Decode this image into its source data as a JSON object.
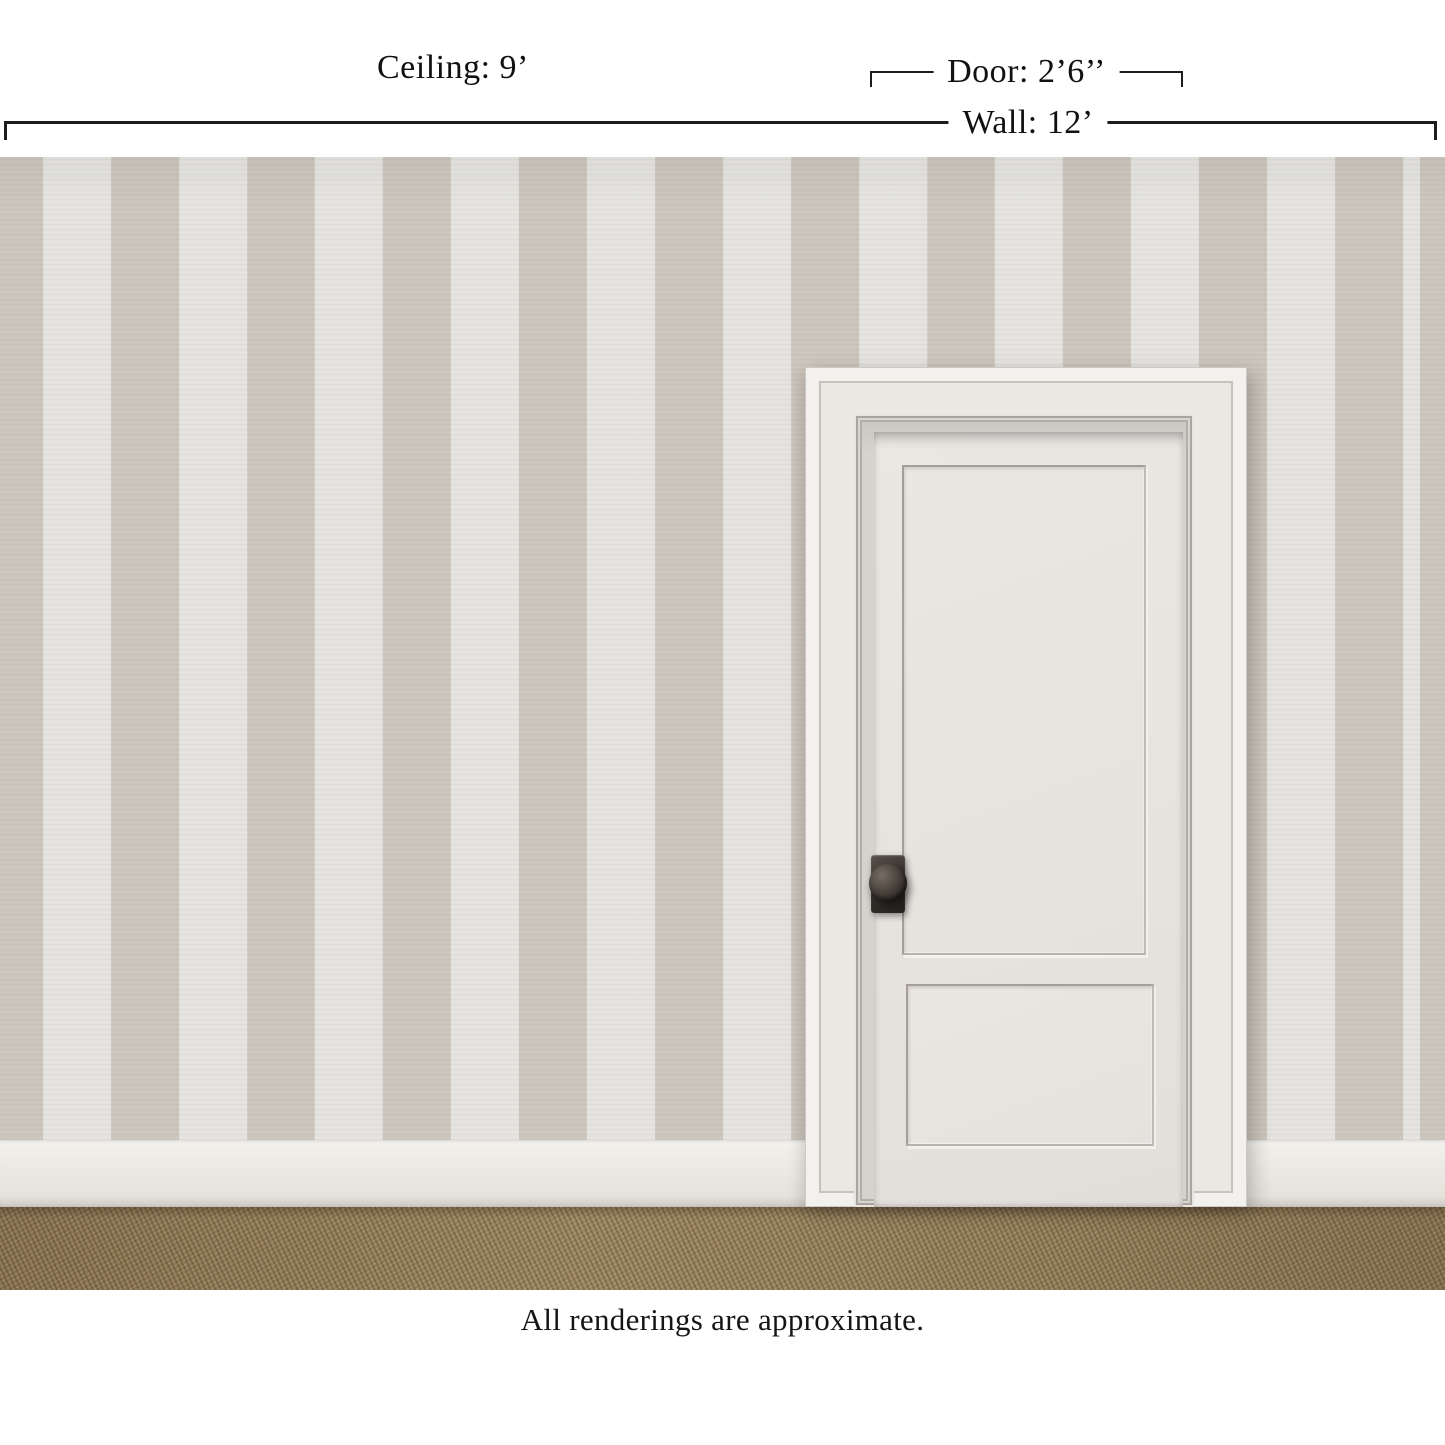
{
  "annotations": {
    "ceiling": "Ceiling: 9’",
    "door": "Door: 2’6’’",
    "wall": "Wall: 12’",
    "disclaimer": "All renderings are approximate."
  },
  "scene": {
    "wallpaper": {
      "pattern": "vertical-stripes",
      "stripe_width_px": 68
    }
  },
  "theme": {
    "stripe-dark": "#cbc5bc",
    "stripe-light": "#e4e3df",
    "door-face": "#ebe8e3",
    "slab-face": "#e7e3df",
    "knob": "#2b2724",
    "baseboard": "#ebe8e2",
    "carpet": "#9a8560",
    "line": "#1d1d1d",
    "text": "#111111",
    "bg": "#ffffff"
  }
}
